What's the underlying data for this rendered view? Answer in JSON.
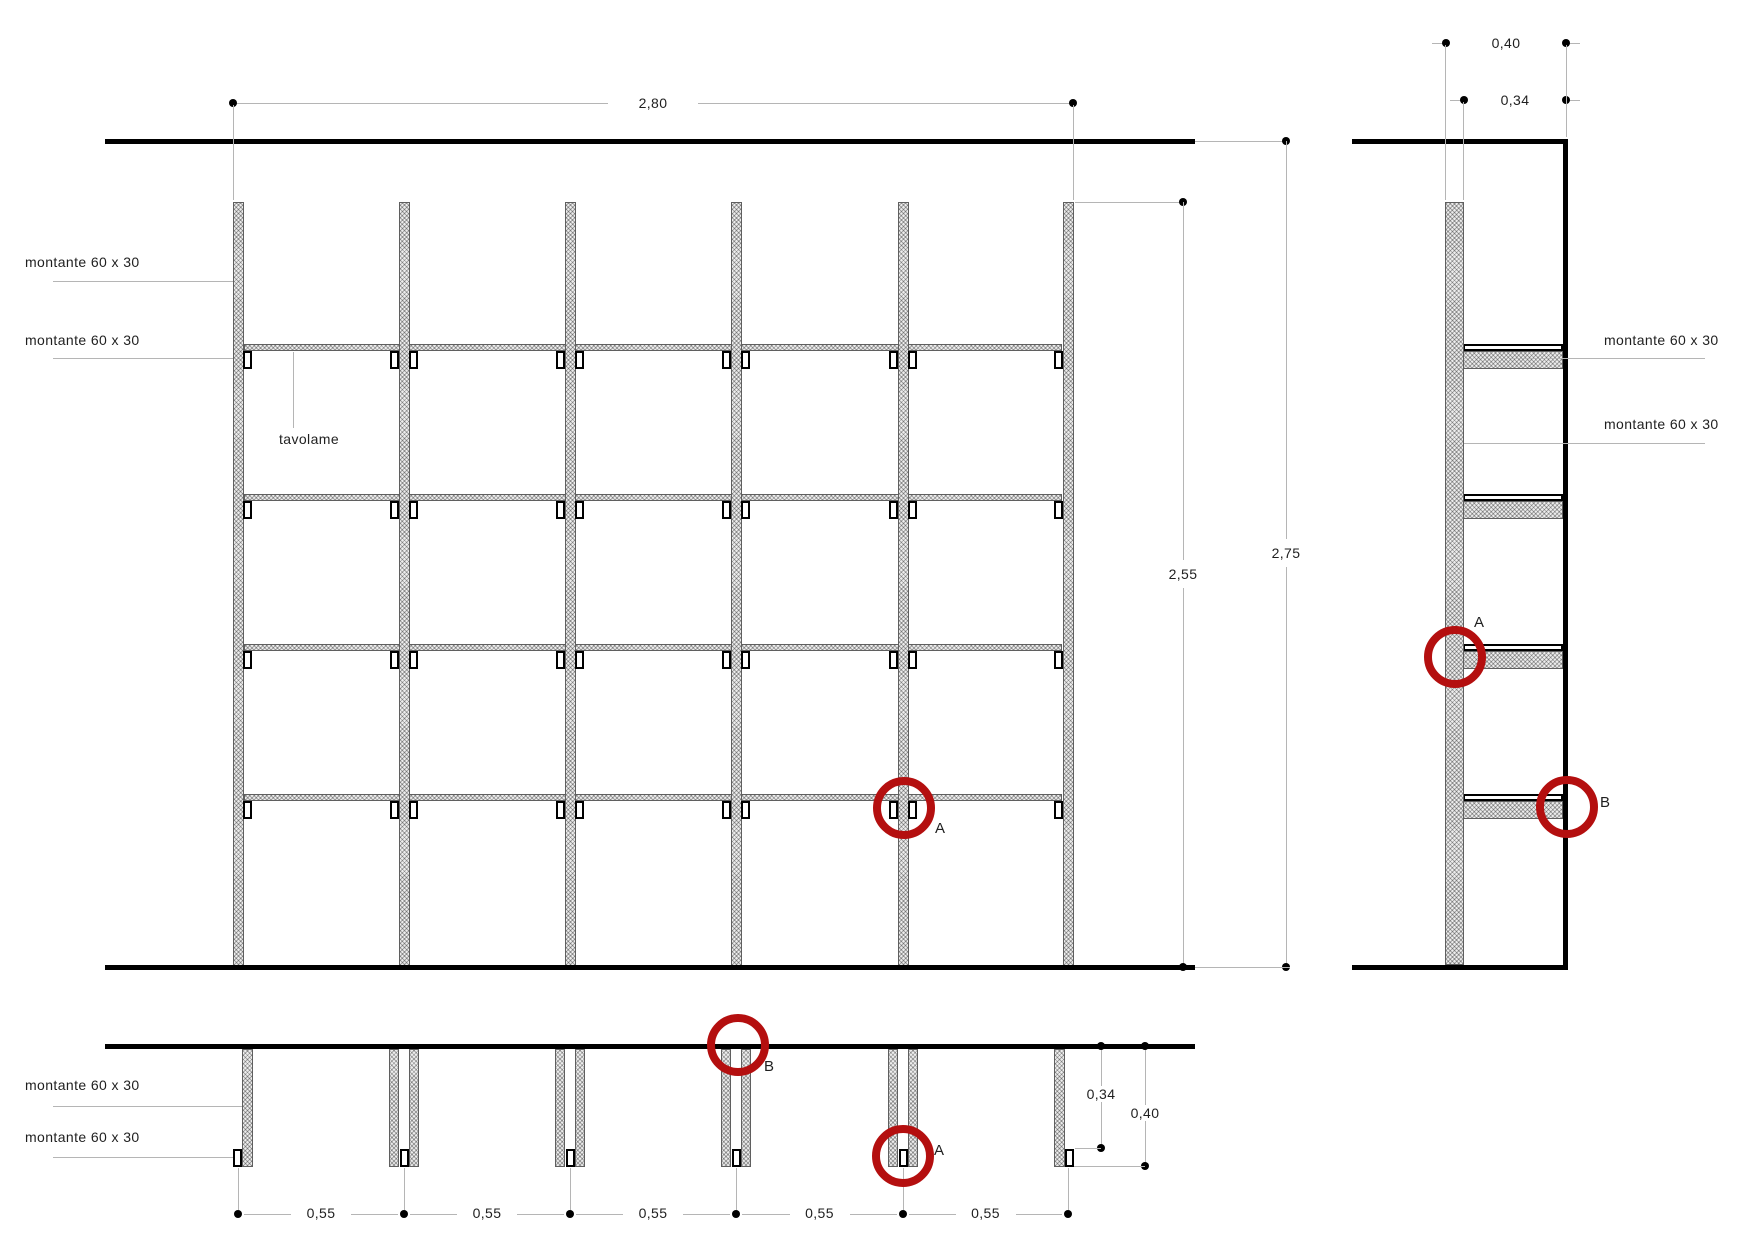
{
  "drawing": {
    "front_view": {
      "labels": {
        "montante_upper": "montante 60 x 30",
        "montante_lower": "montante 60 x 30",
        "tavolame": "tavolame",
        "detail_a": "A"
      },
      "dimensions": {
        "width": "2,80",
        "height_posts": "2,55",
        "height_total": "2,75"
      }
    },
    "side_view": {
      "labels": {
        "montante_upper": "montante 60 x 30",
        "montante_lower": "montante 60 x 30",
        "detail_a": "A",
        "detail_b": "B"
      },
      "dimensions": {
        "depth_total": "0,40",
        "depth_shelf": "0,34"
      }
    },
    "plan_view": {
      "labels": {
        "montante_upper": "montante 60 x 30",
        "montante_lower": "montante 60 x 30",
        "detail_a": "A",
        "detail_b": "B"
      },
      "dimensions": {
        "bays": [
          "0,55",
          "0,55",
          "0,55",
          "0,55",
          "0,55"
        ],
        "depth_shelf": "0,34",
        "depth_total": "0,40"
      }
    },
    "colors": {
      "detail_marker": "#b40f0f",
      "drawing_line": "#000000",
      "dimension_line": "#b5b5b5",
      "hatch_fill": "#ededed",
      "text": "#1f1f1f"
    }
  }
}
